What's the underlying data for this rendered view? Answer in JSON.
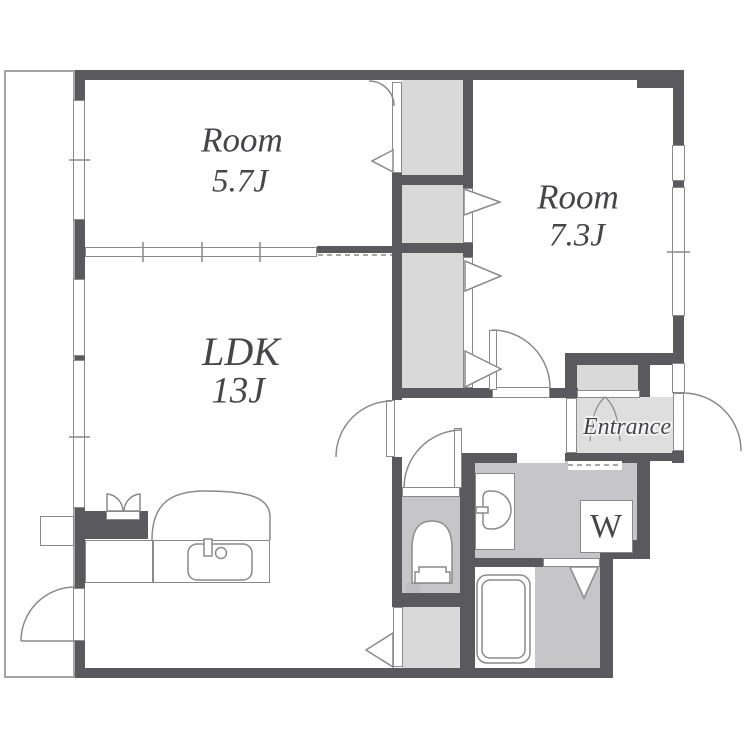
{
  "colors": {
    "wall": "#5a5a5e",
    "fill_light": "#d9d9d9",
    "fill_lighter": "#dedede",
    "fill_mid": "#c6c6c9",
    "fill_stove": "#d2d2d4",
    "line": "#8a8a8a",
    "line_soft": "#a5a5a7",
    "text": "#46464a"
  },
  "labels": {
    "room_a": {
      "name": "Room",
      "size": "5.7J"
    },
    "room_b": {
      "name": "Room",
      "size": "7.3J"
    },
    "ldk": {
      "name": "LDK",
      "size": "13J"
    },
    "entrance": "Entrance",
    "washing_machine": "W"
  }
}
